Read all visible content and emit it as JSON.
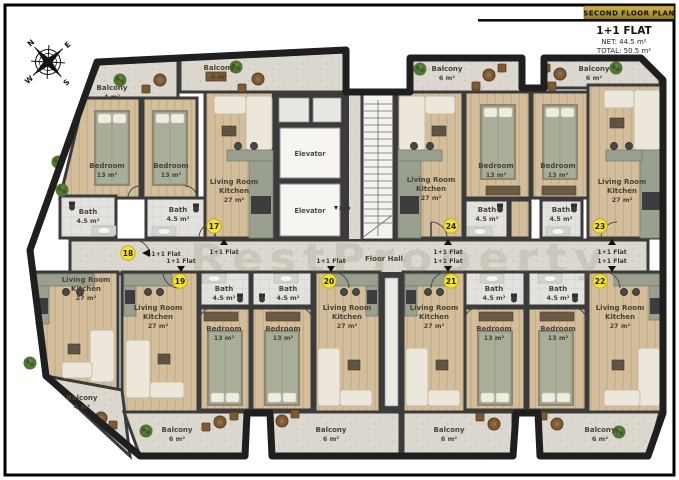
{
  "title_block": {
    "banner": "SECOND FLOOR PLAN",
    "flat_type": "1+1 FLAT",
    "net": "NET: 44.5 m²",
    "total": "TOTAL: 50.5 m²"
  },
  "compass": {
    "n": "N",
    "e": "E",
    "s": "S",
    "w": "W"
  },
  "watermark": "RestProperty",
  "corridor": {
    "label": "Floor Hall",
    "entry_label": "1+1 Flat"
  },
  "core": {
    "elevator": "Elevator",
    "level_mark": "8.10"
  },
  "rooms": {
    "living": {
      "line1": "Living Room",
      "line2": "Kitchen",
      "area": "27 m²"
    },
    "bedroom": {
      "label": "Bedroom",
      "area": "13 m²"
    },
    "bath": {
      "label": "Bath",
      "area": "4.5 m²"
    },
    "balcony": {
      "label": "Balcony",
      "area_small": "4 m²",
      "area_large": "6 m²"
    }
  },
  "flat_numbers": {
    "f17": "17",
    "f18": "18",
    "f19": "19",
    "f20": "20",
    "f21": "21",
    "f22": "22",
    "f23": "23",
    "f24": "24"
  },
  "colors": {
    "banner_gold": "#b5993d",
    "badge_yellow": "#f2e33a",
    "wall": "#3b3b3b",
    "wood_floor": "#d3bd9b",
    "stone_floor": "#dcd8cf"
  }
}
